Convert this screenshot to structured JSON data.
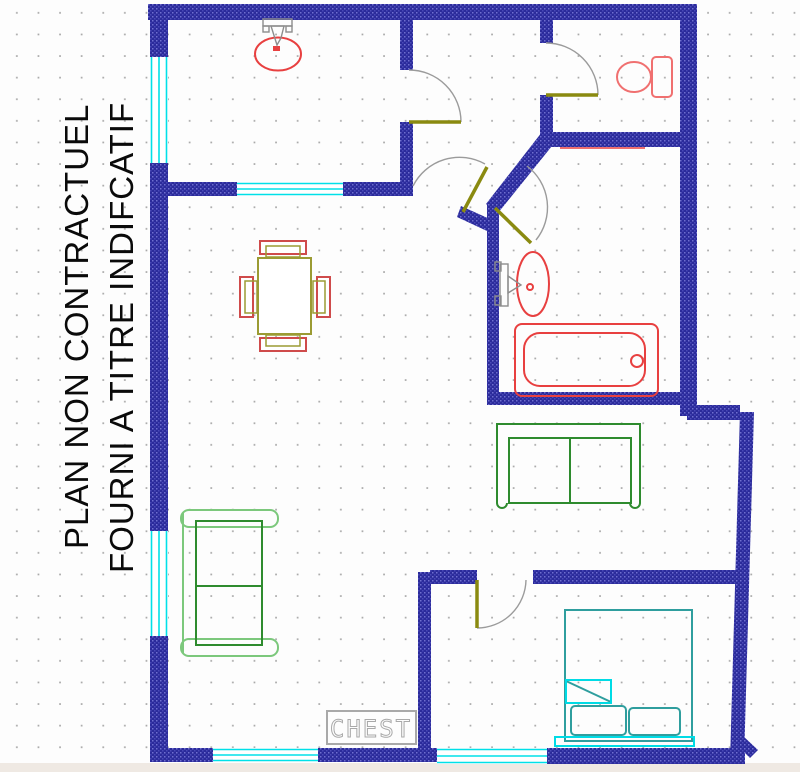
{
  "plan": {
    "disclaimer_line1": "PLAN NON CONTRACTUEL",
    "disclaimer_line2": "FOURNI A TITRE INDIFCATIF",
    "chest_label": "CHEST"
  },
  "colors": {
    "wall_blue": "#2b2b9b",
    "wall_texture": "#6f6fcf",
    "window_cyan": "#00e0e8",
    "door_leaf_olive": "#8a8a10",
    "door_swing_gray": "#9b9b9b",
    "fixture_red": "#e84040",
    "toilet_red": "#f07070",
    "faucet_gray": "#8d8d8d",
    "sofa_green": "#2e8b2e",
    "sofa_light_green": "#7cc87c",
    "table_olive": "#9b9b33",
    "chair_red": "#cf4b4b",
    "bed_teal": "#2f9e9e",
    "bed_cyan": "#00dbe5",
    "chest_gray": "#a9a9a9",
    "text_black": "#0a0a0a",
    "grid_dot": "#969696",
    "background": "#fdfdfd",
    "footer_strip": "#efe9e3"
  }
}
